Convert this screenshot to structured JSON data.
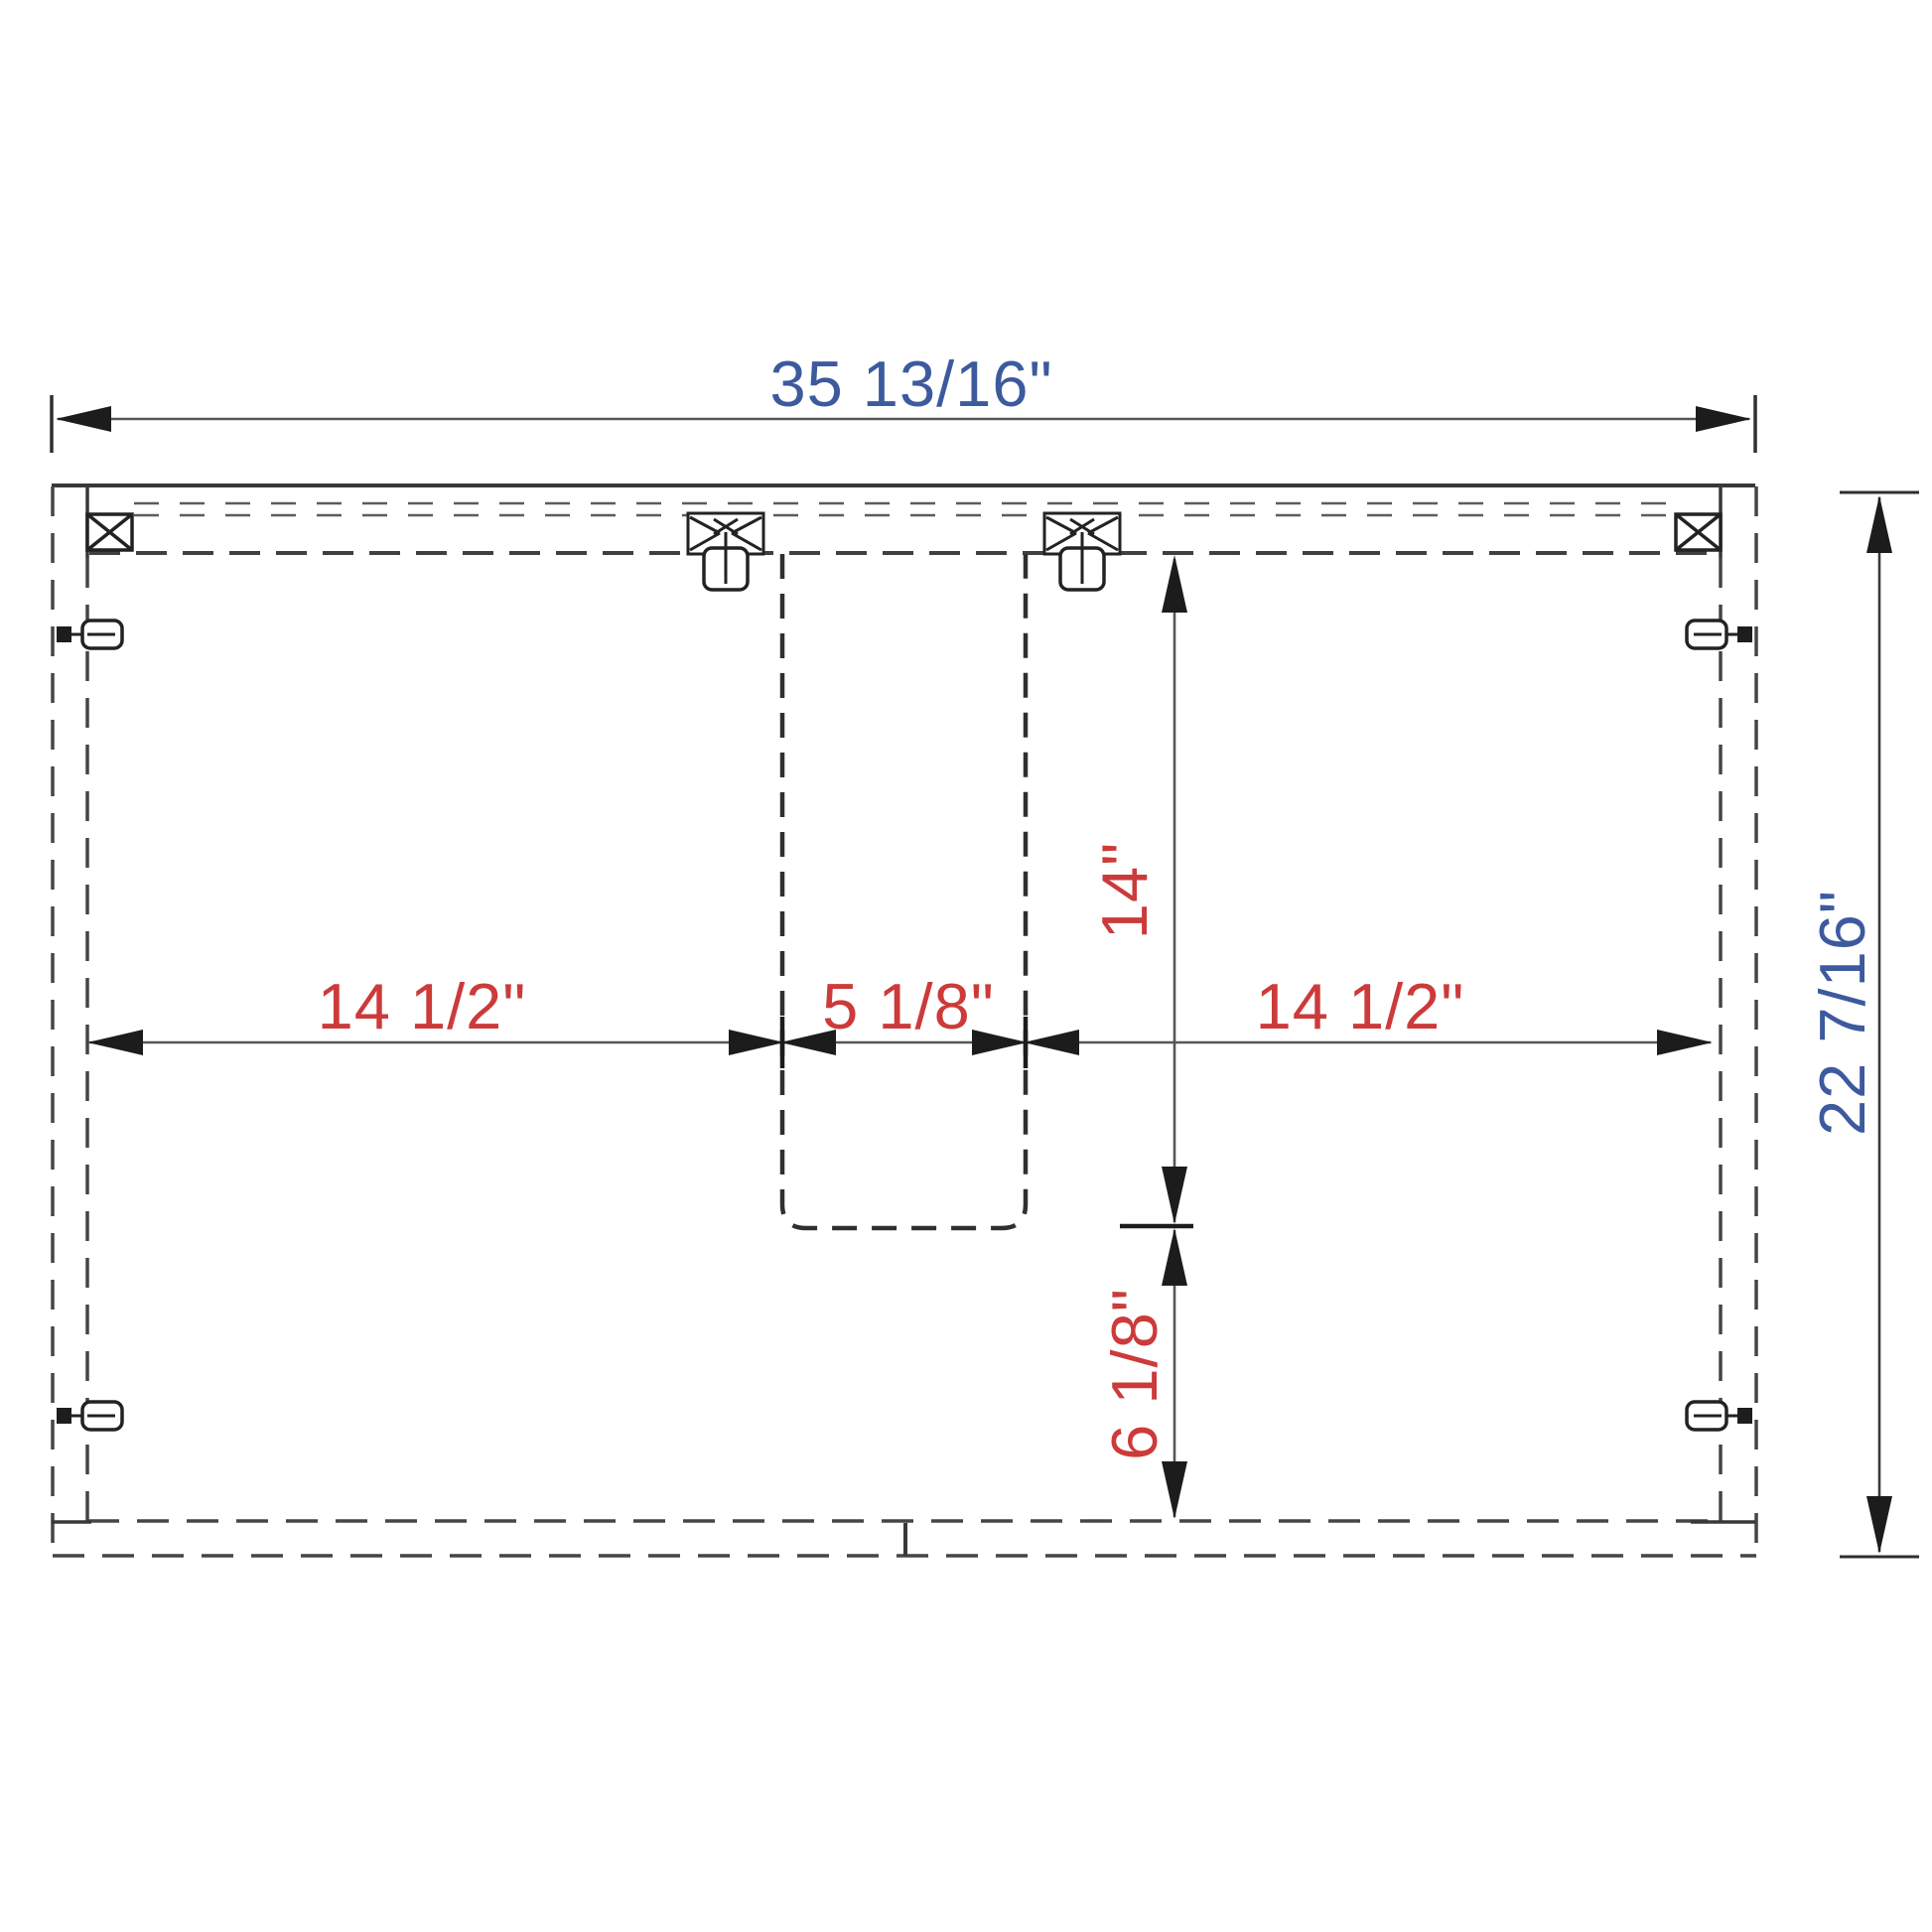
{
  "drawing": {
    "type": "cabinet-assembly-technical-drawing",
    "units": "\"",
    "dimensions": {
      "overall_width": {
        "label": "35 13/16\""
      },
      "overall_height": {
        "label": "22 7/16\""
      },
      "left_opening": {
        "label": "14 1/2\""
      },
      "cutout_width": {
        "label": "5 1/8\""
      },
      "right_opening": {
        "label": "14 1/2\""
      },
      "cutout_depth": {
        "label": "14\""
      },
      "bottom_offset": {
        "label": "6 1/8\""
      }
    },
    "colors": {
      "overall_dim": "#3d5a9e",
      "detail_dim": "#cc3a3a",
      "line_solid": "#383838",
      "line_dashed": "#454545",
      "arrow": "#1c1c1c"
    },
    "hardware": [
      "corner-bracket-icon",
      "corner-bracket-icon",
      "dowel-screw-icon",
      "dowel-screw-icon",
      "cam-lock-icon",
      "cam-lock-icon",
      "cam-lock-icon",
      "cam-lock-icon"
    ]
  }
}
